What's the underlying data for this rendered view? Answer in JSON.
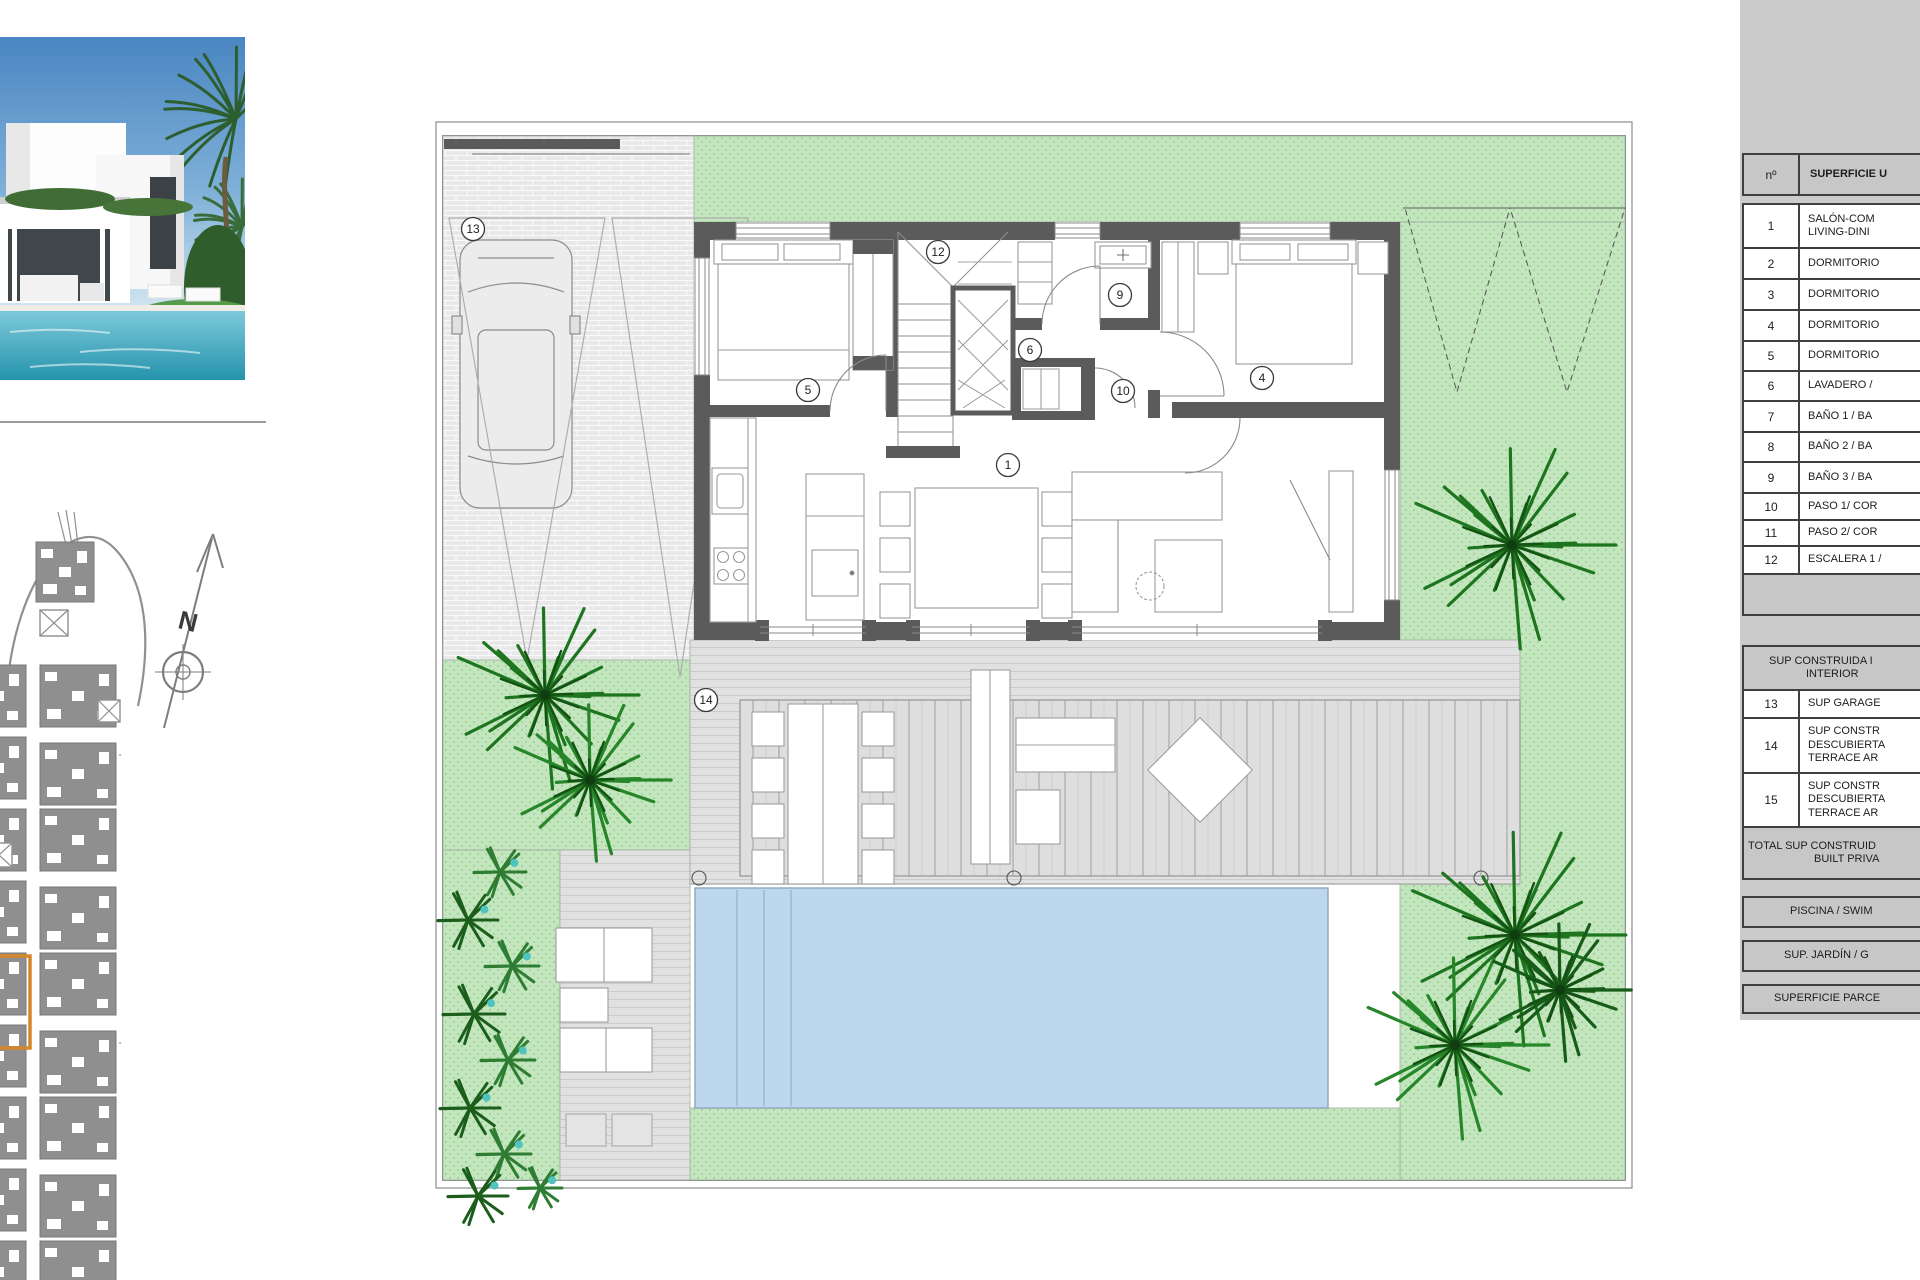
{
  "sheet": {
    "type_label": "floor-plan-sheet"
  },
  "photo": {
    "description": "modern white villa with swimming pool and palm trees"
  },
  "site_plan": {
    "compass_label": "N",
    "highlight_color": "#d4862a"
  },
  "plan": {
    "room_labels": [
      {
        "n": "13",
        "x": 473,
        "y": 229
      },
      {
        "n": "12",
        "x": 938,
        "y": 252
      },
      {
        "n": "9",
        "x": 1120,
        "y": 295
      },
      {
        "n": "5",
        "x": 808,
        "y": 390
      },
      {
        "n": "6",
        "x": 1030,
        "y": 350
      },
      {
        "n": "10",
        "x": 1123,
        "y": 391
      },
      {
        "n": "4",
        "x": 1262,
        "y": 378
      },
      {
        "n": "1",
        "x": 1008,
        "y": 465
      },
      {
        "n": "14",
        "x": 706,
        "y": 700
      }
    ],
    "colors": {
      "garden": "#c3e6be",
      "wall": "#5b5b5b",
      "pool": "#bdd7ee",
      "deck": "#e0e0e0",
      "paver": "#e8e8e8"
    }
  },
  "table": {
    "rows": [
      {
        "kind": "head",
        "h": 41,
        "num": "nº",
        "lines": [
          "SUPERFICIE U"
        ],
        "indents": [
          10
        ]
      },
      {
        "kind": "gap",
        "h": 9,
        "lines": []
      },
      {
        "kind": "item",
        "h": 44,
        "num": "1",
        "lines": [
          "SALÓN-COM",
          "LIVING-DINI"
        ]
      },
      {
        "kind": "item",
        "h": 31,
        "num": "2",
        "lines": [
          "DORMITORIO"
        ]
      },
      {
        "kind": "item",
        "h": 31,
        "num": "3",
        "lines": [
          "DORMITORIO"
        ]
      },
      {
        "kind": "item",
        "h": 31,
        "num": "4",
        "lines": [
          "DORMITORIO"
        ]
      },
      {
        "kind": "item",
        "h": 30,
        "num": "5",
        "lines": [
          "DORMITORIO"
        ]
      },
      {
        "kind": "item",
        "h": 30,
        "num": "6",
        "lines": [
          "LAVADERO /"
        ]
      },
      {
        "kind": "item",
        "h": 31,
        "num": "7",
        "lines": [
          "BAÑO 1 / BA"
        ]
      },
      {
        "kind": "item",
        "h": 30,
        "num": "8",
        "lines": [
          "BAÑO 2 / BA"
        ]
      },
      {
        "kind": "item",
        "h": 31,
        "num": "9",
        "lines": [
          "BAÑO 3 / BA"
        ]
      },
      {
        "kind": "item",
        "h": 27,
        "num": "10",
        "lines": [
          "PASO 1/ COR"
        ]
      },
      {
        "kind": "item",
        "h": 26,
        "num": "11",
        "lines": [
          "PASO 2/ COR"
        ]
      },
      {
        "kind": "item",
        "h": 28,
        "num": "12",
        "lines": [
          "ESCALERA 1 /"
        ]
      },
      {
        "kind": "band",
        "h": 41,
        "lines": []
      },
      {
        "kind": "gap",
        "h": 31,
        "lines": []
      },
      {
        "kind": "summary",
        "h": 44,
        "lines": [
          "SUP CONSTRUIDA I",
          "INTERIOR"
        ],
        "indents": [
          25,
          62
        ]
      },
      {
        "kind": "item",
        "h": 28,
        "num": "13",
        "lines": [
          "SUP GARAGE"
        ]
      },
      {
        "kind": "item",
        "h": 55,
        "num": "14",
        "lines": [
          "SUP CONSTR",
          "DESCUBIERTA",
          "TERRACE AR"
        ]
      },
      {
        "kind": "item",
        "h": 54,
        "num": "15",
        "lines": [
          "SUP CONSTR",
          "DESCUBIERTA",
          "TERRACE AR"
        ]
      },
      {
        "kind": "summary",
        "h": 52,
        "lines": [
          "TOTAL SUP CONSTRUID",
          "BUILT PRIVA"
        ],
        "indents": [
          4,
          70
        ]
      },
      {
        "kind": "gap",
        "h": 18,
        "lines": []
      },
      {
        "kind": "summary",
        "h": 30,
        "lines": [
          "PISCINA / SWIM"
        ],
        "indents": [
          46
        ]
      },
      {
        "kind": "gap",
        "h": 14,
        "lines": []
      },
      {
        "kind": "summary",
        "h": 30,
        "lines": [
          "SUP. JARDÍN / G"
        ],
        "indents": [
          40
        ]
      },
      {
        "kind": "gap",
        "h": 14,
        "lines": []
      },
      {
        "kind": "summary",
        "h": 30,
        "lines": [
          "SUPERFICIE PARCE"
        ],
        "indents": [
          30
        ]
      }
    ]
  }
}
